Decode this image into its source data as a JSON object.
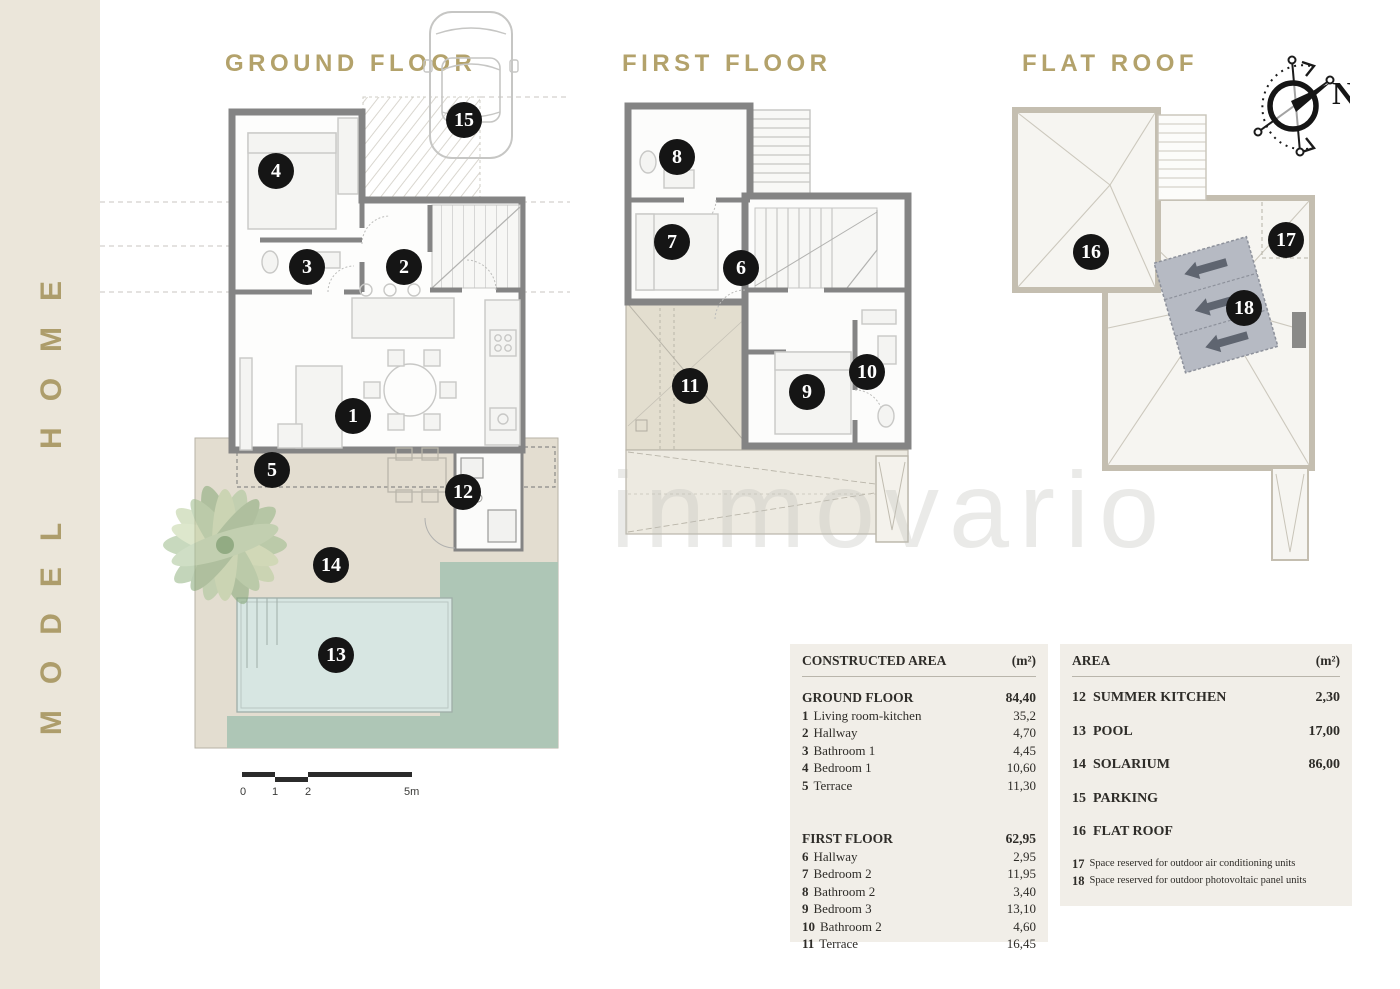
{
  "sidebar": {
    "title": "MODEL HOME"
  },
  "watermark": "inmovario",
  "compass": {
    "north_label": "N"
  },
  "scale_bar": {
    "labels": [
      "0",
      "1",
      "2",
      "5m"
    ]
  },
  "plans": {
    "ground": {
      "title": "GROUND FLOOR",
      "markers": [
        {
          "label": "15",
          "x": 464,
          "y": 120
        },
        {
          "label": "4",
          "x": 276,
          "y": 171
        },
        {
          "label": "3",
          "x": 307,
          "y": 267
        },
        {
          "label": "2",
          "x": 404,
          "y": 267
        },
        {
          "label": "1",
          "x": 353,
          "y": 416
        },
        {
          "label": "5",
          "x": 272,
          "y": 470
        },
        {
          "label": "12",
          "x": 463,
          "y": 492
        },
        {
          "label": "14",
          "x": 331,
          "y": 565
        },
        {
          "label": "13",
          "x": 336,
          "y": 655
        }
      ]
    },
    "first": {
      "title": "FIRST FLOOR",
      "markers": [
        {
          "label": "8",
          "x": 677,
          "y": 157
        },
        {
          "label": "7",
          "x": 672,
          "y": 242
        },
        {
          "label": "6",
          "x": 741,
          "y": 268
        },
        {
          "label": "11",
          "x": 690,
          "y": 386
        },
        {
          "label": "9",
          "x": 807,
          "y": 392
        },
        {
          "label": "10",
          "x": 867,
          "y": 372
        }
      ]
    },
    "roof": {
      "title": "FLAT ROOF",
      "markers": [
        {
          "label": "16",
          "x": 1091,
          "y": 252
        },
        {
          "label": "17",
          "x": 1286,
          "y": 240
        },
        {
          "label": "18",
          "x": 1244,
          "y": 308
        }
      ]
    }
  },
  "tables": {
    "constructed": {
      "header": {
        "label": "CONSTRUCTED AREA",
        "unit": "(m²)"
      },
      "sections": [
        {
          "name": "GROUND FLOOR",
          "value": "84,40",
          "rows": [
            {
              "num": "1",
              "label": "Living room-kitchen",
              "value": "35,2"
            },
            {
              "num": "2",
              "label": "Hallway",
              "value": "4,70"
            },
            {
              "num": "3",
              "label": "Bathroom 1",
              "value": "4,45"
            },
            {
              "num": "4",
              "label": "Bedroom 1",
              "value": "10,60"
            },
            {
              "num": "5",
              "label": "Terrace",
              "value": "11,30"
            }
          ]
        },
        {
          "name": "FIRST FLOOR",
          "value": "62,95",
          "rows": [
            {
              "num": "6",
              "label": "Hallway",
              "value": "2,95"
            },
            {
              "num": "7",
              "label": "Bedroom 2",
              "value": "11,95"
            },
            {
              "num": "8",
              "label": "Bathroom 2",
              "value": "3,40"
            },
            {
              "num": "9",
              "label": "Bedroom 3",
              "value": "13,10"
            },
            {
              "num": "10",
              "label": "Bathroom 2",
              "value": "4,60"
            },
            {
              "num": "11",
              "label": "Terrace",
              "value": "16,45"
            }
          ]
        }
      ]
    },
    "area": {
      "header": {
        "label": "AREA",
        "unit": "(m²)"
      },
      "rows": [
        {
          "num": "12",
          "label": "SUMMER KITCHEN",
          "value": "2,30",
          "style": "major"
        },
        {
          "num": "13",
          "label": "POOL",
          "value": "17,00",
          "style": "major"
        },
        {
          "num": "14",
          "label": "SOLARIUM",
          "value": "86,00",
          "style": "major"
        },
        {
          "num": "15",
          "label": "PARKING",
          "value": "",
          "style": "major"
        },
        {
          "num": "16",
          "label": "FLAT ROOF",
          "value": "",
          "style": "major"
        },
        {
          "num": "17",
          "label": "Space reserved for outdoor air conditioning units",
          "value": "",
          "style": "minor"
        },
        {
          "num": "18",
          "label": "Space reserved for outdoor photovoltaic panel units",
          "value": "",
          "style": "minor"
        }
      ]
    }
  },
  "colors": {
    "brand_bar_bg": "#ebe6da",
    "gold": "#b3a26b",
    "wall": "#848484",
    "roof_wall": "#c4beb0",
    "garden_beige": "#e3ddd0",
    "pool_blue": "#d7e6e2",
    "lawn_green": "#aec6b6",
    "legend_bg": "#f1eee8",
    "marker_bg": "#151515",
    "panel_gray": "#b6bac3"
  }
}
